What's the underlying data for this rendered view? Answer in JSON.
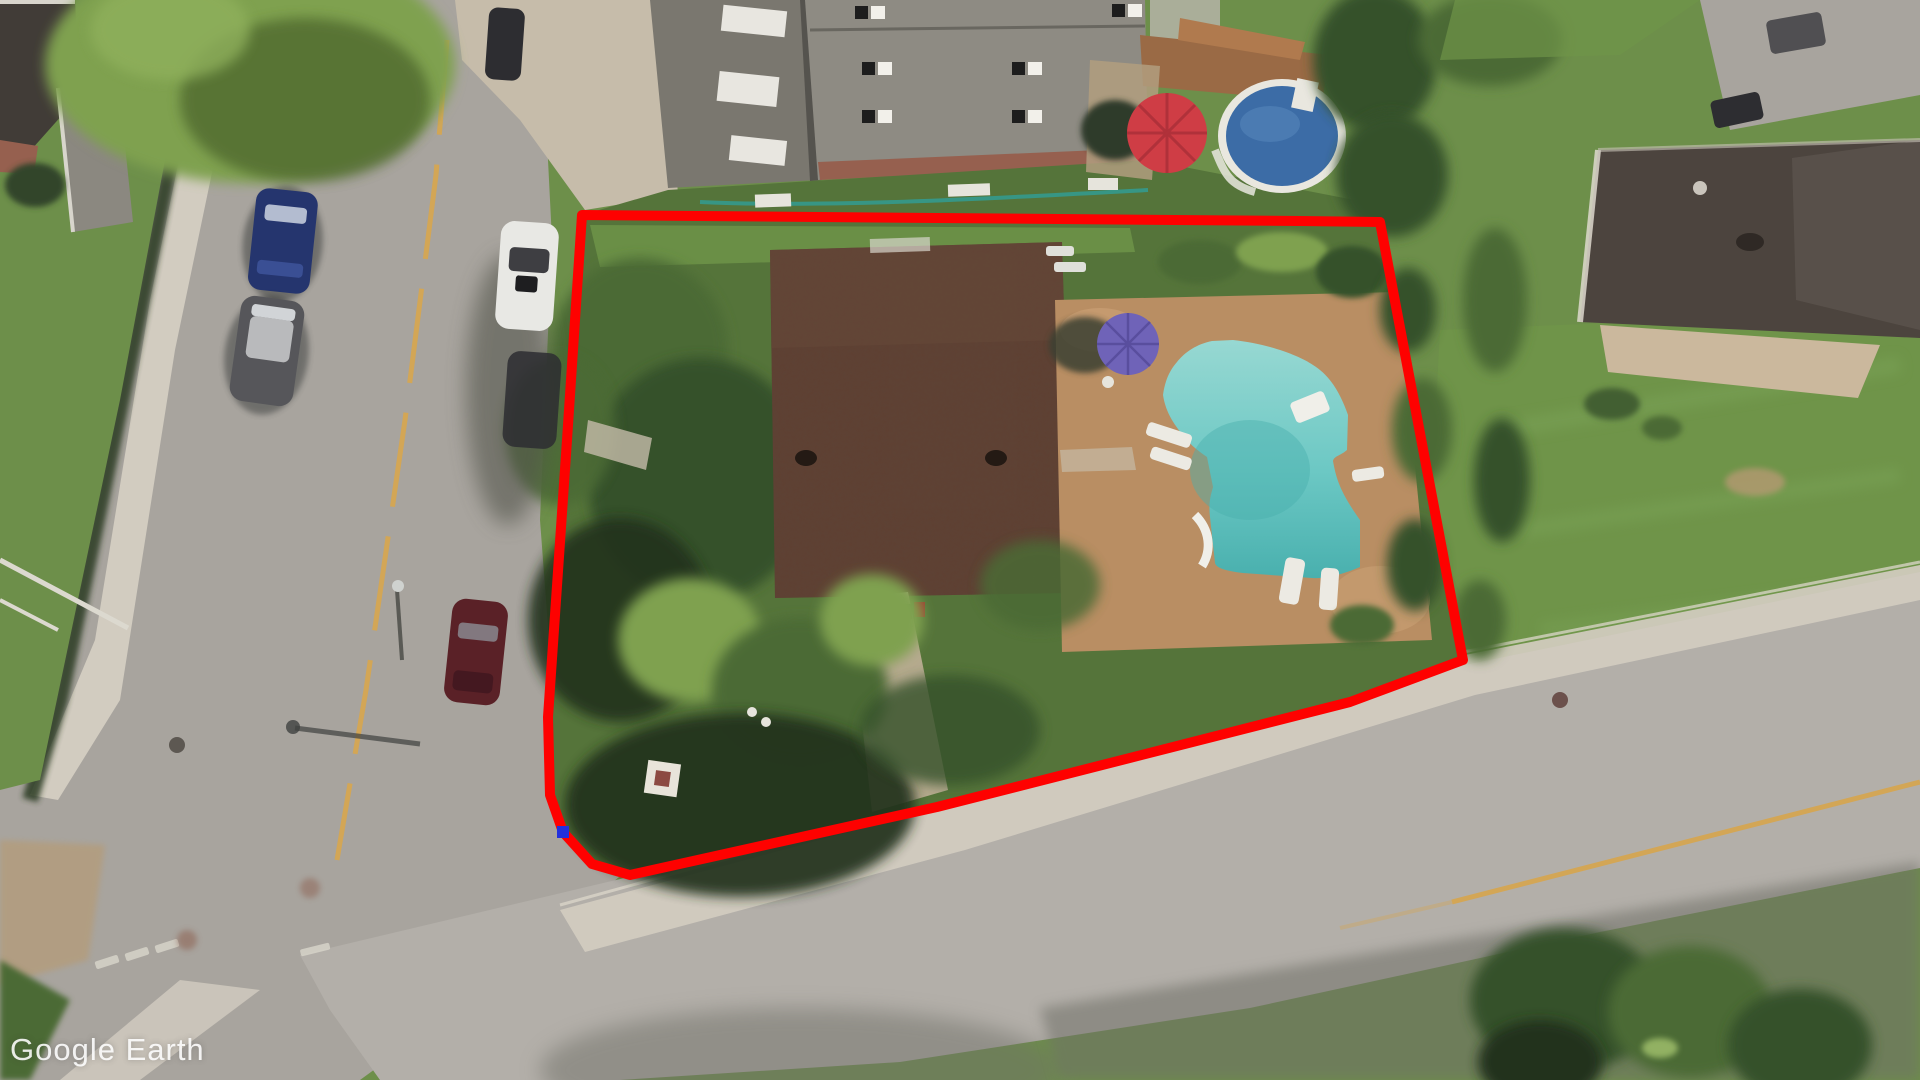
{
  "app": {
    "watermark_text": "Google Earth"
  },
  "annotation": {
    "type": "property-boundary-polygon",
    "outline_color": "#fe0100",
    "outline_width": 10,
    "points": "582,215 1300,221 1380,222 1463,660 1350,702 937,807 630,875 592,864 563,832 550,795 548,717 567,440",
    "vertex_marker": {
      "x": 563,
      "y": 832,
      "size": 12,
      "color": "#2230dd"
    }
  },
  "scene": {
    "type": "oblique-aerial-imagery",
    "colors": {
      "road": "#a8a49e",
      "road2": "#b3afa9",
      "sidewalk": "#d2ccc0",
      "concrete": "#c6bcaa",
      "dirt": "#b29d7f",
      "grass": "#6d8f4a",
      "grassDark": "#55743a",
      "lawn": "#6f9449",
      "treeLight": "#7fa14f",
      "tree": "#4c6a36",
      "treeDark": "#36512a",
      "shadow": "#24331d",
      "roofMain": "#5d4336",
      "roofGray": "#8e8b83",
      "roofGrayDark": "#7a776f",
      "roofDark": "#4c443e",
      "brick": "#96604f",
      "rim": "#e9e7df",
      "poolRound": "#3c6ca6",
      "pool": "#6cc8c4",
      "poolLight": "#97d8d2",
      "poolDark": "#49b0ae",
      "patio": "#b98e63",
      "deck": "#9a6a45",
      "umbRed": "#cf3d45",
      "umbPurple": "#6f63b8",
      "lineYellow": "#d7a64e",
      "white": "#e9e7e2",
      "carBlue": "#25356e",
      "carGray": "#56565a",
      "carWhite": "#e8e8e4",
      "carMaroon": "#5a2127",
      "carDark": "#2d2d31",
      "asphaltShadow": "#6f7068"
    }
  }
}
